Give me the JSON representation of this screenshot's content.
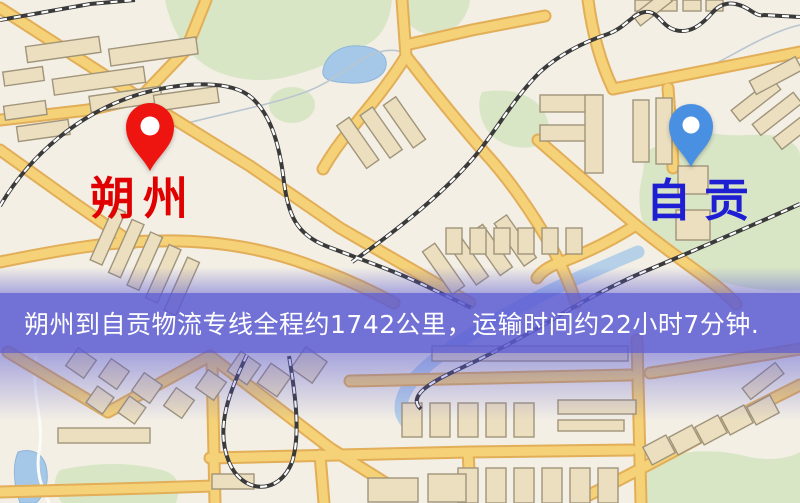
{
  "banner": {
    "text": "朔州到自贡物流专线全程约1742公里，运输时间约22小时7分钟."
  },
  "markers": {
    "origin": {
      "label": "朔州",
      "pin_color": "#ee1511",
      "label_color": "#e00000",
      "icon": "location-pin-icon"
    },
    "destination": {
      "label": "自贡",
      "pin_color": "#4a90e2",
      "label_color": "#1e1ed2",
      "icon": "location-pin-icon"
    }
  },
  "colors": {
    "map_bg": "#f3efe5",
    "road_fill": "#f5d178",
    "road_casing": "#e2ae58",
    "building_fill": "#ecdfc0",
    "building_stroke": "#a0947a",
    "green": "#d9e6c6",
    "water": "#a6c8e8",
    "railway": "#3a3a3a",
    "banner_bg": "rgba(90,90,212,0.85)",
    "banner_text": "#ffffff",
    "origin_label": "#e00000",
    "dest_label": "#1e1ed2"
  }
}
